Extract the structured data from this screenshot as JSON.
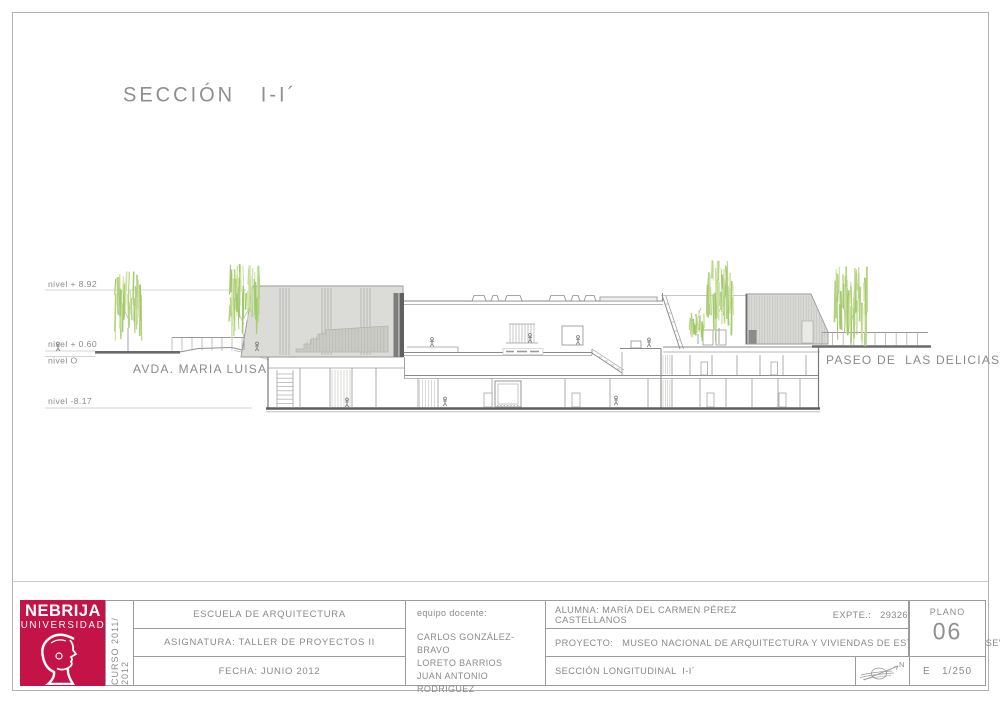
{
  "page": {
    "title": "SECCIÓN   I-I´"
  },
  "drawing": {
    "levels": [
      {
        "label": "nivel  + 8.92"
      },
      {
        "label": "nivel  + 0.60"
      },
      {
        "label": "nivel  O"
      },
      {
        "label": "nivel  -8.17"
      }
    ],
    "street_left": "AVDA. MARIA LUISA",
    "street_right": "PASEO DE  LAS DELICIAS"
  },
  "title_block": {
    "logo_name": "NEBRIJA",
    "logo_sub": "UNIVERSIDAD",
    "curso": "CURSO 2011/ 2012",
    "school": "ESCUELA DE ARQUITECTURA",
    "subject": "ASIGNATURA: TALLER DE PROYECTOS II",
    "date": "FECHA: JUNIO 2012",
    "team_label": "equipo docente:",
    "team": [
      "CARLOS GONZÁLEZ-BRAVO",
      "LORETO BARRIOS",
      "JUAN ANTONIO RODRIGUEZ"
    ],
    "student": "ALUMNA: MARÍA DEL CARMEN PÉREZ CASTELLANOS",
    "expte": "EXPTE.:   29326",
    "project": "PROYECTO:   MUSEO NACIONAL DE ARQUITECTURA Y VIVIENDAS DE ESTUDIANTES EN  SEVILLA",
    "sheet_title": "SECCIÓN LONGITUDINAL  I-I´",
    "north_label": "N",
    "plano_label": "PLANO",
    "plano_number": "06",
    "scale": "E   1/250"
  }
}
